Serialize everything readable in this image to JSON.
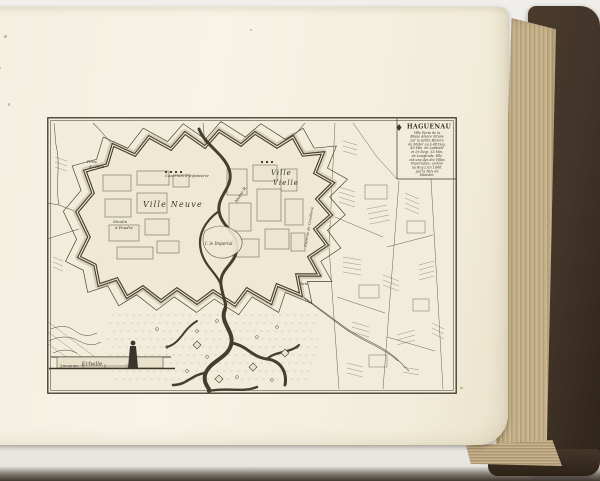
{
  "scene": {
    "background_color": "#ecebe7",
    "book": {
      "cover_color": "#43352a",
      "fore_edge_color": "#c3ae85",
      "page_color": "#f5f1e1",
      "shadow_color": "#231b12"
    }
  },
  "map": {
    "ink_color": "#3b352b",
    "plate_color": "#f2edda",
    "title_block": {
      "title": "HAGUENAU",
      "description_lines": [
        "Ville Forte de la",
        "Basse Alsace Située",
        "sur la petite Riviere",
        "de Moter ou à 48 Deg.",
        "49 Min. de Latitude",
        "et 29 Degr. 33 Min.",
        "de Longitude. Elle",
        "est une des dix Villes",
        "Imperialles. cedées",
        "au Roy L'an 1648.",
        "par la Paix de",
        "Munster."
      ]
    },
    "labels": {
      "ville_neuve": "Ville Neuve",
      "ville_vielle_line1": "Ville",
      "ville_vielle_line2": "Vielle",
      "casernes_infanterie": "Casernes d'Infanterie",
      "moulin_line1": "Moulin",
      "moulin_line2": "à Poudre",
      "river_moter": "Moter R.",
      "isle_imperial": "I. le Imperial",
      "cazerne_cavallerie": "Cazerne de Cavallerie",
      "porte_du_rhin_line1": "Porte",
      "porte_du_rhin_line2": "du Rhin",
      "porte_south": "Porte",
      "echelle": "Echelle",
      "scale_values": "50      100      300"
    }
  }
}
